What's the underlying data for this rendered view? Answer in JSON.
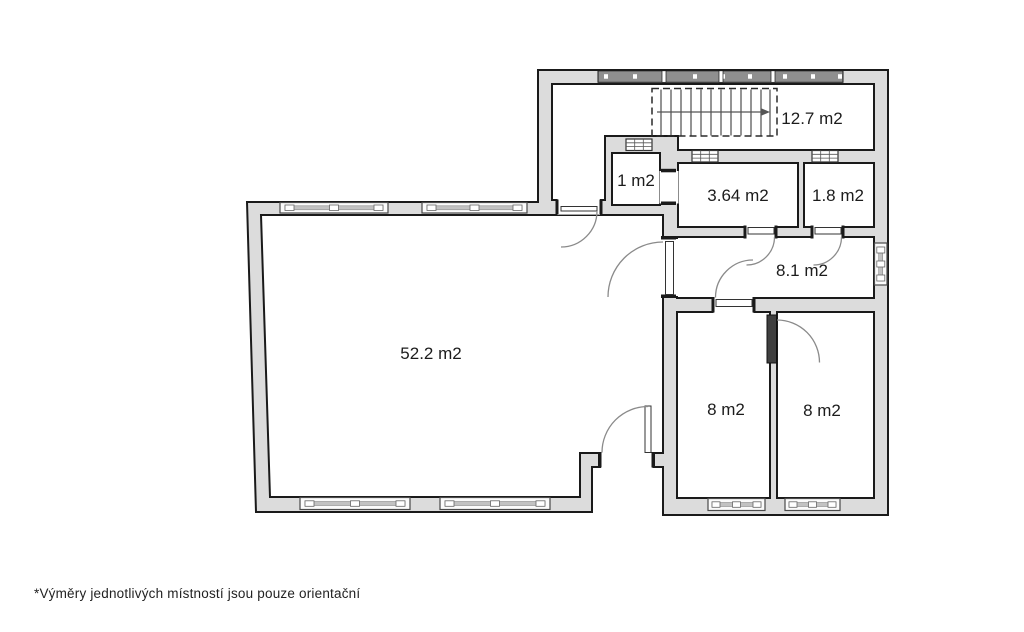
{
  "plan": {
    "type": "floor-plan",
    "colors": {
      "wall_fill": "#dcdcdc",
      "wall_outline": "#1a1a1a",
      "label": "#1c1c1c",
      "living_label": "#8f8f8f",
      "window_band": "#8f8f8f"
    },
    "rooms": [
      {
        "id": "living-room",
        "area_label": "52.2 m2"
      },
      {
        "id": "staircase-hall",
        "area_label": "12.7 m2"
      },
      {
        "id": "closet",
        "area_label": "1 m2"
      },
      {
        "id": "bathroom",
        "area_label": "3.64 m2"
      },
      {
        "id": "wc",
        "area_label": "1.8 m2"
      },
      {
        "id": "hallway",
        "area_label": "8.1 m2"
      },
      {
        "id": "bedroom-left",
        "area_label": "8 m2"
      },
      {
        "id": "bedroom-right",
        "area_label": "8 m2"
      }
    ],
    "footnote": "*Výměry jednotlivých místností jsou pouze orientační"
  }
}
